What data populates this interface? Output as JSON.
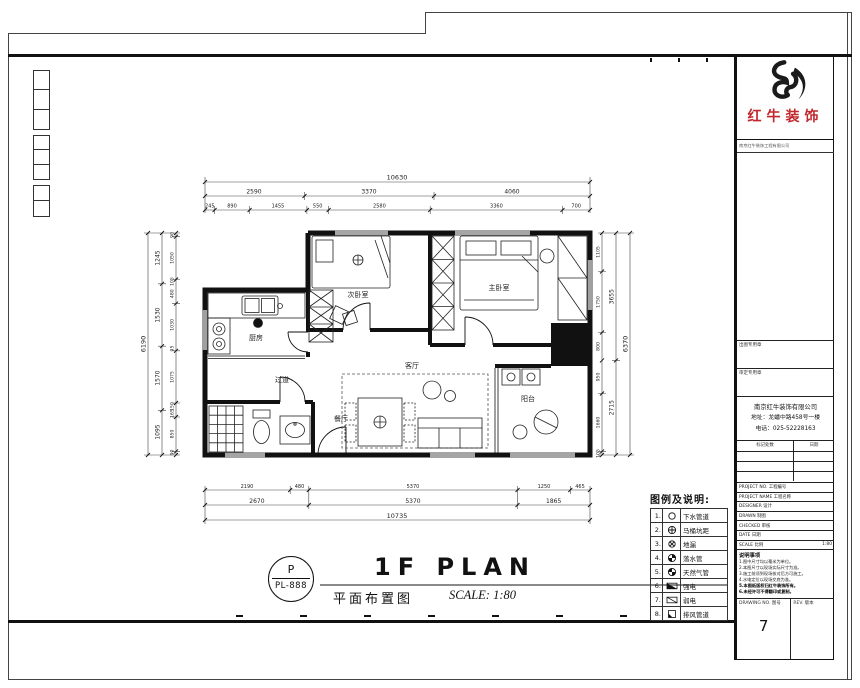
{
  "brand": {
    "name": "红牛装饰",
    "reg_line": "南京红牛装饰工程有限公司"
  },
  "title_group": {
    "stamp_letter": "P",
    "stamp_code": "PL-888",
    "title_en": "1F PLAN",
    "title_cn": "平面布置图",
    "scale_note": "SCALE: 1:80"
  },
  "plan": {
    "rooms": {
      "kitchen": "厨房",
      "bedroom2": "次卧室",
      "master": "主卧室",
      "hall": "过道",
      "dining": "餐厅",
      "living": "客厅",
      "balcony": "阳台"
    }
  },
  "dims": {
    "top": {
      "total": "10630",
      "row2": [
        "2590",
        "3370",
        "4060"
      ],
      "row3": [
        "245",
        "890",
        "1455",
        "550",
        "2580",
        "3360",
        "700"
      ]
    },
    "bottom": {
      "row1": [
        "2190",
        "480",
        "5370",
        "1250",
        "465"
      ],
      "row2": [
        "2670",
        "5370",
        "1865"
      ],
      "total": "10735"
    },
    "left": {
      "total": "6190",
      "mids": [
        "1245",
        "1530",
        "1570",
        "1095"
      ],
      "subs": [
        "90",
        "1050",
        "105",
        "480",
        "1030",
        "95",
        "1075",
        "150",
        "165",
        "850",
        "90"
      ]
    },
    "right": {
      "total": "6370",
      "mids": [
        "3655",
        "2715"
      ],
      "subs": [
        "1105",
        "1750",
        "800",
        "950",
        "1660",
        "105"
      ]
    }
  },
  "legend": {
    "title": "图例及说明:",
    "items": [
      {
        "no": "1.",
        "icon": "drain-pipe-icon",
        "label": "下水管道"
      },
      {
        "no": "2.",
        "icon": "toilet-rough-in-icon",
        "label": "马桶坑距"
      },
      {
        "no": "3.",
        "icon": "floor-drain-icon",
        "label": "地漏"
      },
      {
        "no": "4.",
        "icon": "downspout-icon",
        "label": "落水管"
      },
      {
        "no": "5.",
        "icon": "gas-pipe-icon",
        "label": "天然气管"
      },
      {
        "no": "6.",
        "icon": "strong-electric-icon",
        "label": "强电"
      },
      {
        "no": "7.",
        "icon": "weak-electric-icon",
        "label": "弱电"
      },
      {
        "no": "8.",
        "icon": "exhaust-duct-icon",
        "label": "排风管道"
      }
    ]
  },
  "title_block": {
    "seal_box1": "出图专用章",
    "seal_box2": "审定专用章",
    "company": {
      "name": "南京红牛装饰有限公司",
      "address": "地址：龙蟠中路458号一楼",
      "phone": "电话：025-52228163"
    },
    "rev_header": {
      "left": "标记处数",
      "right": "日期"
    },
    "fields": [
      {
        "label": "PROJECT NO. 工程编号",
        "value": ""
      },
      {
        "label": "PROJECT NAME 工程名称",
        "value": ""
      },
      {
        "label": "DESIGNER 设计",
        "value": ""
      },
      {
        "label": "DRAWN 制图",
        "value": ""
      },
      {
        "label": "CHECKED 审核",
        "value": ""
      },
      {
        "label": "DATE 日期",
        "value": ""
      },
      {
        "label": "SCALE 比例",
        "value": "1:80"
      }
    ],
    "notes_title": "说明事项",
    "notes": [
      "1.图中尺寸均以毫米为单位。",
      "2.本图尺寸以现场实际尺寸为准。",
      "3.施工前须到现场核对后方可施工。",
      "4.水电定位以现场交底为准。",
      "5.本图纸版权归红牛装饰所有。",
      "6.未经许可不得翻印或复制。"
    ],
    "dwg_no_label": "DRAWING NO. 图号",
    "rev_label": "REV. 版本",
    "page_number": "7"
  }
}
